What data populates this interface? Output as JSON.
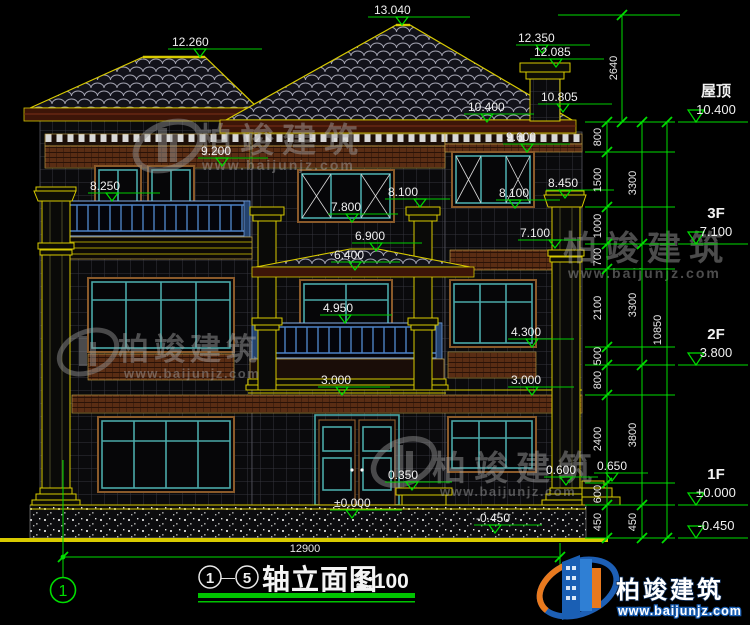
{
  "drawing": {
    "title_axis_start": "1",
    "title_dash": "—",
    "title_axis_end": "5",
    "title": "轴立面图",
    "scale": "1:100",
    "axis_bubble": "1"
  },
  "logo": {
    "name": "柏竣建筑",
    "url": "www.baijunjz.com"
  },
  "watermark": {
    "name": "柏竣建筑",
    "url": "www.baijunjz.com"
  },
  "marks": {
    "m13040": "13.040",
    "m12260": "12.260",
    "m12350": "12.350",
    "m12085": "12.085",
    "m10805": "10.805",
    "m10400": "10.400",
    "m9600": "9.600",
    "m9200": "9.200",
    "m8450": "8.450",
    "m8250": "8.250",
    "m8100c": "8.100",
    "m8100r": "8.100",
    "m7800": "7.800",
    "m7100": "7.100",
    "m6900": "6.900",
    "m6400": "6.400",
    "m4950": "4.950",
    "m4300": "4.300",
    "m3000c": "3.000",
    "m3000r": "3.000",
    "m0350": "0.350",
    "m0000": "±0.000",
    "m0600": "0.600",
    "m0650": "0.650",
    "mneg045": "-0.450"
  },
  "levels": [
    {
      "name": "屋顶",
      "elev": "10.400"
    },
    {
      "name": "3F",
      "elev": "7.100"
    },
    {
      "name": "2F",
      "elev": "3.800"
    },
    {
      "name": "1F",
      "elev": "±0.000"
    },
    {
      "name": "",
      "elev": "-0.450"
    }
  ],
  "dims": {
    "top": "2640",
    "chain1": [
      "800",
      "1500",
      "1000",
      "700",
      "2100",
      "500",
      "800",
      "2400",
      "600",
      "450"
    ],
    "chain2": [
      "3300",
      "3300",
      "3800",
      "450"
    ],
    "total": "10850",
    "width": "12900"
  }
}
